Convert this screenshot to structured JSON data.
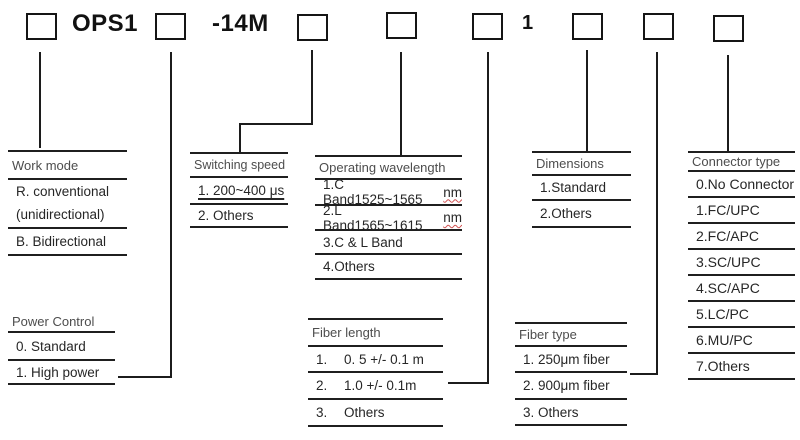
{
  "codes": {
    "prefix": "OPS1",
    "model": "-14M",
    "fixed_digit": "1"
  },
  "tables": {
    "work_mode": {
      "title": "Work mode",
      "row1_line1": "R. conventional",
      "row1_line2": "(unidirectional)",
      "row2": "B. Bidirectional"
    },
    "switching_speed": {
      "title": "Switching speed",
      "row1": "1. 200~400 μs",
      "row2": "2. Others"
    },
    "operating_wavelength": {
      "title": "Operating wavelength",
      "row1_main": "1.C Band1525~1565",
      "row1_unit": "nm",
      "row2_main": "2.L Band1565~1615",
      "row2_unit": "nm",
      "row3": "3.C & L Band",
      "row4": "4.Others"
    },
    "dimensions": {
      "title": "Dimensions",
      "row1": "1.Standard",
      "row2": "2.Others"
    },
    "connector_type": {
      "title": "Connector type",
      "rows": [
        "0.No Connector",
        "1.FC/UPC",
        "2.FC/APC",
        "3.SC/UPC",
        "4.SC/APC",
        "5.LC/PC",
        "6.MU/PC",
        "7.Others"
      ]
    },
    "power_control": {
      "title": "Power Control",
      "row1": "0. Standard",
      "row2": "1. High power"
    },
    "fiber_length": {
      "title": "Fiber length",
      "rows": [
        {
          "num": "1.",
          "val": "0. 5 +/- 0.1 m"
        },
        {
          "num": "2.",
          "val": "1.0 +/- 0.1m"
        },
        {
          "num": "3.",
          "val": "Others"
        }
      ]
    },
    "fiber_type": {
      "title": "Fiber type",
      "row1": "1. 250μm fiber",
      "row2": "2. 900μm fiber",
      "row3": "3. Others"
    }
  }
}
